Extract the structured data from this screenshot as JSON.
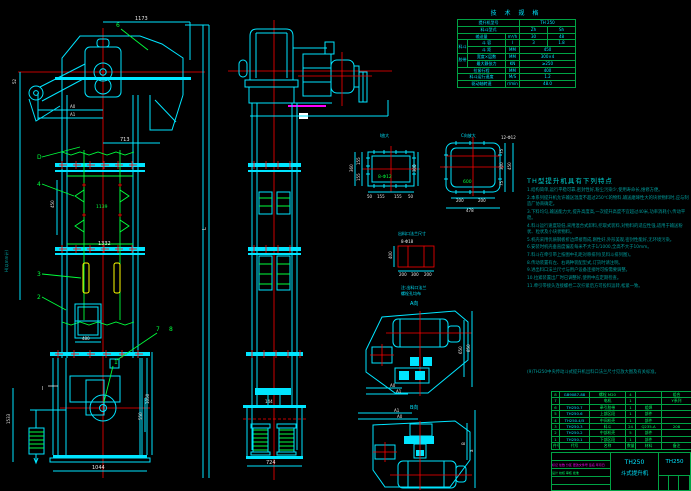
{
  "front_view": {
    "dim_top": "1173",
    "dim_a0": "A0",
    "dim_a1": "A1",
    "dim_52": "52",
    "dim_713": "713",
    "dim_1139": "1139",
    "dim_450": "450",
    "dim_1332": "1332",
    "dim_480": "480",
    "dim_1044": "1044",
    "dim_1533": "1533",
    "dim_1050": "1050",
    "dim_550": "550",
    "dim_L": "L",
    "axis_h": "H(以mm计)",
    "p1": "1",
    "p2": "2",
    "p3": "3",
    "p4": "4",
    "p6": "6",
    "p7": "7",
    "p8": "8",
    "pD": "D",
    "section": "I"
  },
  "side_view": {
    "dim_724": "724",
    "dim_144": "144"
  },
  "detail_i": {
    "title": "I放大",
    "bolts": "8-Φ12",
    "left_1": "155",
    "left_2": "155",
    "left_total": "360",
    "right": "300",
    "bottom": [
      "50",
      "155",
      "155",
      "50"
    ]
  },
  "detail_c": {
    "title": "C向放大",
    "bolts": "12-Φ12",
    "inner": "600",
    "right_1": "75",
    "right_2": "300",
    "right_3": "75",
    "right_total": "450",
    "bottom_1": "200",
    "bottom_2": "200",
    "bottom_total": "478"
  },
  "flange_detail": {
    "title": "出料口法兰尺寸",
    "bolts": "8-Φ18",
    "left": "400",
    "b1": "200",
    "b2": "300",
    "b3": "200",
    "note1": "注:出料口法兰",
    "note2": "螺栓孔均布"
  },
  "view_a": {
    "title": "A向",
    "dim_a0": "A0",
    "dim_a1": "A1",
    "right_1": "650",
    "right_2": "850"
  },
  "view_b": {
    "title": "B向",
    "dim_a0": "A0",
    "dim_a1": "A1",
    "right_1": "B",
    "right_2": "a"
  },
  "tech_table": {
    "title": "技 术 规 格",
    "model_label": "提升机型号",
    "model_value": "TH 250",
    "bucket_type_label": "料斗型式",
    "bucket_type_v1": "Zh",
    "bucket_type_v2": "Sh",
    "capacity_label": "输送量",
    "capacity_unit": "m³/h",
    "capacity_v1": "30",
    "capacity_v2": "48",
    "group_bucket": "料斗",
    "bucket_vol_label": "斗 容",
    "bucket_vol_unit": "l",
    "bucket_vol_v1": "3",
    "bucket_vol_v2": "1.8",
    "bucket_pitch_label": "斗 距",
    "bucket_pitch_unit": "MM",
    "bucket_pitch_value": "450",
    "group_belt": "胶带",
    "belt_width_label": "宽度×层数",
    "belt_width_unit": "MM",
    "belt_width_value": "300×4",
    "belt_tension_label": "最大静张力",
    "belt_tension_unit": "KN",
    "belt_tension_value": "≥250",
    "stroke_label": "拉紧行程",
    "stroke_unit": "MM",
    "stroke_value": "400",
    "speed_label": "料斗运行速度",
    "speed_unit": "M/S",
    "speed_value": "1.2",
    "rpm_label": "驱动轴转速",
    "rpm_unit": "r/min",
    "rpm_value": "48.0"
  },
  "notes": {
    "title": "TH型提升机具有下列特点",
    "items": [
      "1.结构简单,运行平稳可靠,密封性好,粉尘污染少,使用寿命长,维修方便。",
      "2.本系列提升机允许输送温度不超过250℃的物料,输送磨琢性大的块状物料时,应与制造厂协商确定。",
      "3.下料均匀,输送能力大,提升高度高,一次提升高度不宜超过40米,功率消耗小,传动平稳。",
      "4.料斗运行速度较低,采用混合式卸料,挖取式装料,对物料的适应性强,适用于输送粉状、粒状及小块状物料。",
      "5.机壳采用优质钢板折边焊接而成,刚性好,外形美观,密封性能好,无环境污染。",
      "6.安装时机壳垂直度偏差每米不大于1/1000,全高不大于10mm。",
      "7.料斗在牵引带上按图中孔距对称排列(见料斗排列图)。",
      "8.传动装置有左、右两种装配型式,订货时请注明。",
      "9.进出料口法兰尺寸与用户设备连接时可按需要调整。",
      "10.拉紧装置出厂时已调整好,使用中应定期检查。",
      "11.牵引带接头连接螺栓二次拧紧后方可投料运转,松紧一致。"
    ],
    "footnote": "(9)TH250中央传动斗式提升机出料口法兰尺寸见放大图及有关标准。"
  },
  "bom": {
    "header": {
      "no": "件号",
      "code": "代号",
      "name": "名称",
      "qty": "数量",
      "mat": "材料",
      "note": "备注"
    },
    "rows": [
      {
        "no": "8",
        "code": "GB9087-88",
        "name": "螺栓 M20",
        "qty": "4",
        "mat": "",
        "note": "组合"
      },
      {
        "no": "7",
        "code": "",
        "name": "电机",
        "qty": "1",
        "mat": "",
        "note": "Y系列"
      },
      {
        "no": "6",
        "code": "TH250.7",
        "name": "牵引胶带",
        "qty": "1",
        "mat": "组焊",
        "note": ""
      },
      {
        "no": "5",
        "code": "TH250.6",
        "name": "上部区段",
        "qty": "1",
        "mat": "部件",
        "note": ""
      },
      {
        "no": "4",
        "code": "TH250.4/5",
        "name": "中间机壳",
        "qty": "1",
        "mat": "部件",
        "note": ""
      },
      {
        "no": "3",
        "code": "TH250.3",
        "name": "料斗",
        "qty": "24",
        "mat": "Q235-A",
        "note": "208"
      },
      {
        "no": "2",
        "code": "TH250.2",
        "name": "中部机壳",
        "qty": "5",
        "mat": "部件",
        "note": ""
      },
      {
        "no": "1",
        "code": "TH250.1",
        "name": "下部区段",
        "qty": "1",
        "mat": "部件",
        "note": ""
      }
    ]
  },
  "title_block": {
    "rev_line": "标记 处数 分区 更改文件号 签名 年月日",
    "sign_line": "设计  校核  审核  批准",
    "product_line1": "TH250",
    "product_line2": "斗式提升机",
    "drawing_no": "TH250"
  }
}
